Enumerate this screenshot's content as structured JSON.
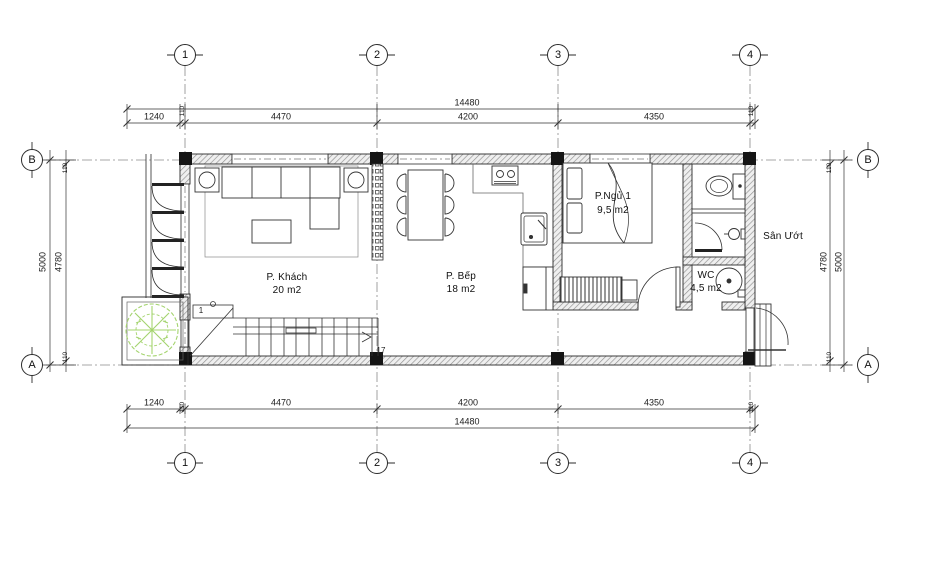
{
  "plan": {
    "grid_columns": [
      "1",
      "2",
      "3",
      "4"
    ],
    "grid_rows": [
      "B",
      "A"
    ],
    "dims": {
      "total": "14480",
      "seg_porch": "1240",
      "seg_offset": "110",
      "seg_1_2": "4470",
      "seg_2_3": "4200",
      "seg_3_4": "4350",
      "side_total": "5000",
      "side_inner": "4780",
      "side_offset": "110"
    },
    "rooms": {
      "living": {
        "name": "P. Khách",
        "area": "20 m2"
      },
      "kitchen": {
        "name": "P. Bếp",
        "area": "18 m2"
      },
      "bedroom": {
        "name": "P.Ngủ 1",
        "area": "9,5 m2"
      },
      "wc": {
        "name": "WC",
        "area": "4,5 m2"
      }
    },
    "labels": {
      "wet_yard": "Sân Ướt",
      "stair_first": "1",
      "stair_last": "17"
    },
    "colors": {
      "line": "#2b2b2b",
      "wall_hatch": "#8f8f8f",
      "tree": "#a4d46e"
    }
  }
}
